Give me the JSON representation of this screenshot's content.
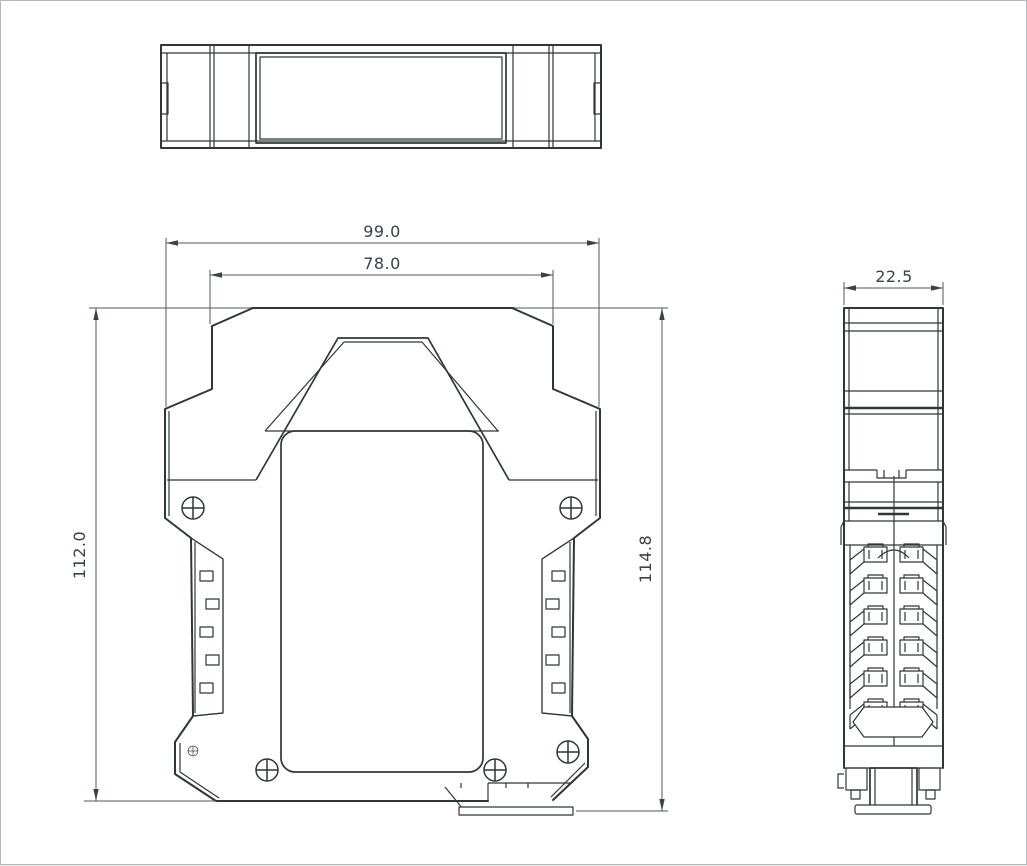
{
  "drawing": {
    "type": "engineering-drawing",
    "dimensions": {
      "overall_width": "99.0",
      "top_width": "78.0",
      "body_height": "112.0",
      "total_height": "114.8",
      "depth": "22.5"
    },
    "colors": {
      "background": "#ffffff",
      "drawing_line": "#2f3737",
      "dimension_line": "#4e585d",
      "dimension_text": "#39424a",
      "frame_border": "#b5baba"
    }
  }
}
